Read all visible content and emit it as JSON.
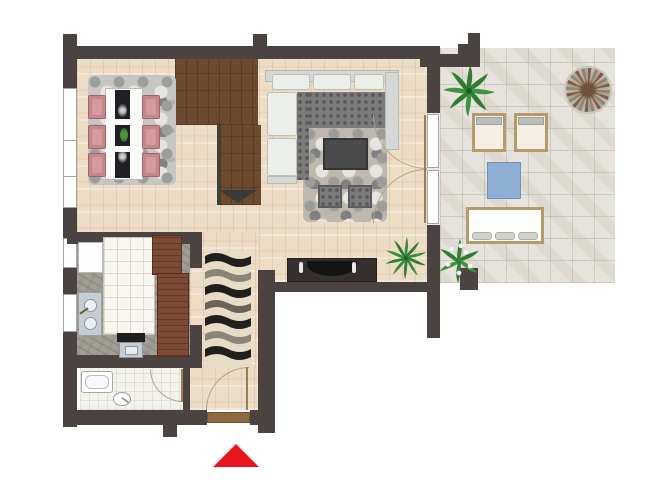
{
  "meta": {
    "kind": "apartment-floor-plan",
    "width_px": 650,
    "height_px": 480,
    "visible_text": "none"
  },
  "colors": {
    "wall": "#4b4242",
    "wood": "#eeddc6",
    "terrace": "#e6e3dc",
    "closet": "#6b4a2f",
    "cabinet": "#7c4a35",
    "marble": "#a29f96",
    "bathtile": "#f4f2ed",
    "ruggray": "#c7c6c3",
    "rugliving": "#beb8ae",
    "sofaframe": "#d6d8d5",
    "sofacushion": "#eceee9",
    "sofaseat": "#7b7b7b",
    "chairpink": "#c4878a",
    "runner": "#201f24",
    "tablewhite": "#fbfbf9",
    "console": "#35302f",
    "tv": "#141414",
    "leaf": "#2e7d32",
    "benchwood": "#b59a6b",
    "cushion": "#d2d2cc",
    "bluetable": "#8fb0d6",
    "threshold": "#8a6a3e",
    "arc": "#b3a489",
    "red": "#ea161d",
    "winframe": "#a3a3a3",
    "steel": "#c7ccd1"
  },
  "rooms": [
    {
      "id": "dining-area",
      "floor": "light-wood",
      "furniture": [
        "pebble-rug",
        "dining-table",
        "black-table-runner",
        "runner-medallion",
        "runner-medallion",
        "centerpiece-plant",
        "dining-chair-x6"
      ]
    },
    {
      "id": "living-room",
      "floor": "light-wood",
      "furniture": [
        "corner-sofa",
        "pebble-rug",
        "coffee-table",
        "pouf",
        "pouf",
        "tv-console",
        "tv",
        "candlestick",
        "candlestick",
        "potted-plant"
      ]
    },
    {
      "id": "closet-stairs-nook",
      "floor": "dark-wood",
      "furniture": [
        "direction-arrow"
      ]
    },
    {
      "id": "kitchen",
      "floor": "gray-marble",
      "furniture": [
        "fridge",
        "tiled-counter",
        "double-sink",
        "stove",
        "cabinet",
        "cabinet"
      ]
    },
    {
      "id": "bathroom",
      "floor": "white-tile",
      "furniture": [
        "bathtub",
        "toilet"
      ]
    },
    {
      "id": "hallway",
      "floor": "light-wood",
      "furniture": [
        "wave-runner-rug"
      ]
    },
    {
      "id": "terrace",
      "floor": "stone-tile",
      "furniture": [
        "palm-plant",
        "mosaic-ornament",
        "armchair",
        "armchair",
        "blue-side-table",
        "bench-sofa",
        "bench-cushion-x3",
        "flower-plant"
      ]
    }
  ],
  "doors": [
    {
      "id": "entrance-door",
      "type": "swing",
      "marker": "red-triangle"
    },
    {
      "id": "bathroom-door",
      "type": "swing"
    },
    {
      "id": "terrace-french-doors",
      "type": "double-swing"
    }
  ],
  "windows": [
    {
      "id": "left-window-large"
    },
    {
      "id": "left-window-small-1"
    },
    {
      "id": "left-window-small-2"
    }
  ],
  "marker": {
    "id": "entrance-marker",
    "shape": "triangle-up",
    "color": "#ea161d"
  }
}
